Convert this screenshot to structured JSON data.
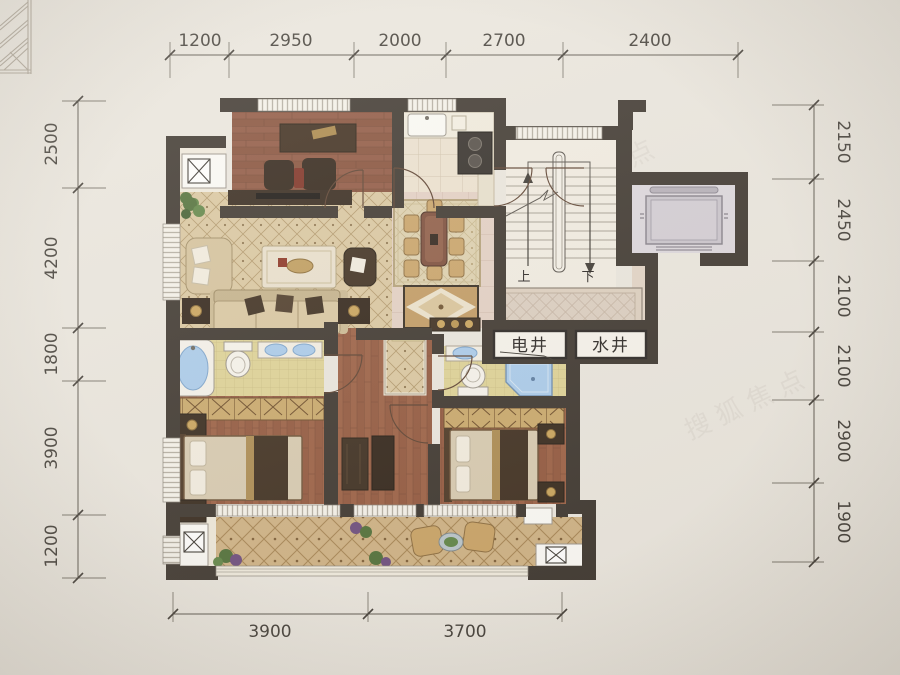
{
  "scene": {
    "type": "apartment-floor-plan-photo",
    "paper_color": "#eae6de"
  },
  "dimensions": {
    "top": [
      "1200",
      "2950",
      "2000",
      "2700",
      "2400"
    ],
    "bottom": [
      "3900",
      "3700"
    ],
    "left": [
      "2500",
      "4200",
      "1800",
      "3900",
      "1200"
    ],
    "right": [
      "2150",
      "2450",
      "2100",
      "2100",
      "2900",
      "1900"
    ]
  },
  "plan_labels": {
    "electrical_shaft": "电井",
    "water_shaft": "水井",
    "stair_up": "上",
    "stair_down": "下"
  },
  "watermark": {
    "text": "搜狐焦点"
  },
  "colors": {
    "wall": "#3a332c",
    "wood_floor": "#9a5e42",
    "living_floor": "#dac7a0",
    "hall_tile": "#e3d0c4",
    "bath_tile": "#ded295",
    "balcony_floor": "#ceb183",
    "water_blue": "#a9cbec",
    "accent_gold": "#c9a35a",
    "elevator_car": "#c9c4cc",
    "dimension_text": "#403c36"
  }
}
